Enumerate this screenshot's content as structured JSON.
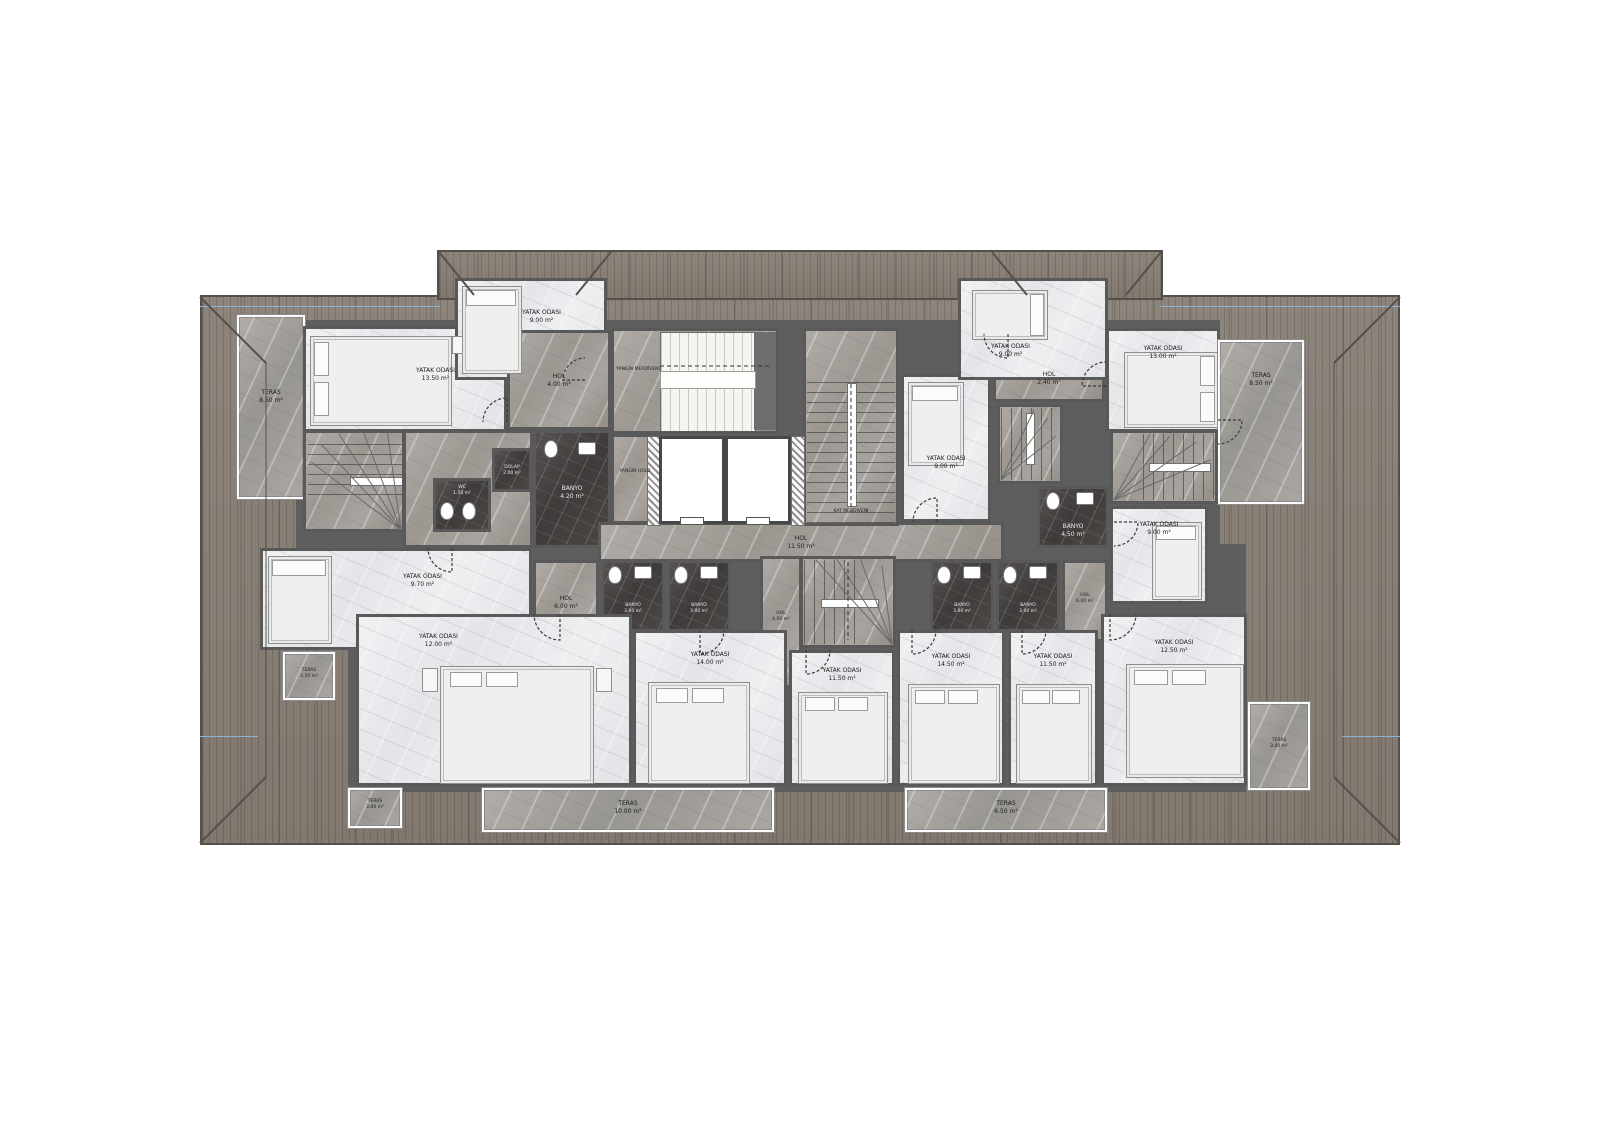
{
  "rooms": {
    "teras_tl": {
      "name": "TERAS",
      "area": "8.50 m²"
    },
    "bed_tl": {
      "name": "YATAK ODASI",
      "area": "13.50 m²"
    },
    "dormer_bed_l": {
      "name": "YATAK ODASI",
      "area": "9.00 m²"
    },
    "hol_l1": {
      "name": "HOL",
      "area": "4.00 m²"
    },
    "dolap_l": {
      "name": "DOLAP",
      "area": "2.00 m²"
    },
    "wc_l": {
      "name": "WC",
      "area": "1.50 m²"
    },
    "banyo_l_top": {
      "name": "BANYO",
      "area": "4.20 m²"
    },
    "yangin_merdiveni": {
      "name": "YANGIN MERDİVENİ",
      "area": ""
    },
    "yangin_holu": {
      "name": "YANGIN HOLÜ",
      "area": ""
    },
    "hol_center": {
      "name": "HOL",
      "area": "11.50 m²"
    },
    "kat_merdiveni": {
      "name": "KAT MERDİVENİ",
      "area": ""
    },
    "bed_cr": {
      "name": "YATAK ODASI",
      "area": "9.00 m²"
    },
    "hol_r1": {
      "name": "HOL",
      "area": "2.40 m²"
    },
    "dormer_bed_r": {
      "name": "YATAK ODASI",
      "area": "9.00 m²"
    },
    "bed_tr": {
      "name": "YATAK ODASI",
      "area": "13.00 m²"
    },
    "teras_tr": {
      "name": "TERAS",
      "area": "8.50 m²"
    },
    "banyo_r": {
      "name": "BANYO",
      "area": "4.50 m²"
    },
    "bed_mr": {
      "name": "YATAK ODASI",
      "area": "9.00 m²"
    },
    "bed_ml": {
      "name": "YATAK ODASI",
      "area": "9.70 m²"
    },
    "teras_ml": {
      "name": "TERAS",
      "area": "3.50 m²"
    },
    "hol_l3": {
      "name": "HOL",
      "area": "6.00 m²"
    },
    "banyo_b1": {
      "name": "BANYO",
      "area": "3.00 m²"
    },
    "banyo_b2": {
      "name": "BANYO",
      "area": "3.00 m²"
    },
    "hol_b": {
      "name": "HOL",
      "area": "4.00 m²"
    },
    "banyo_b3": {
      "name": "BANYO",
      "area": "3.00 m²"
    },
    "banyo_b4": {
      "name": "BANYO",
      "area": "3.00 m²"
    },
    "hol_r3": {
      "name": "HOL",
      "area": "6.00 m²"
    },
    "bed_b1": {
      "name": "YATAK ODASI",
      "area": "12.00 m²"
    },
    "teras_b1": {
      "name": "TERAS",
      "area": "3.00 m²"
    },
    "bed_b2": {
      "name": "YATAK ODASI",
      "area": "14.00 m²"
    },
    "bed_b3": {
      "name": "YATAK ODASI",
      "area": "11.50 m²"
    },
    "bed_b4": {
      "name": "YATAK ODASI",
      "area": "14.50 m²"
    },
    "bed_b5": {
      "name": "YATAK ODASI",
      "area": "11.50 m²"
    },
    "bed_b6": {
      "name": "YATAK ODASI",
      "area": "12.50 m²"
    },
    "teras_bc": {
      "name": "TERAS",
      "area": "10.00 m²"
    },
    "teras_br": {
      "name": "TERAS",
      "area": "6.50 m²"
    },
    "teras_br_small": {
      "name": "TERAS",
      "area": "3.00 m²"
    }
  },
  "colors": {
    "roof": "#8d857c",
    "wall": "#5e5e5e",
    "light_room": "#eceef0",
    "gray_marble": "#a39e99",
    "dark_tile": "#474342",
    "section_line_blue": "#8fb6d8"
  }
}
